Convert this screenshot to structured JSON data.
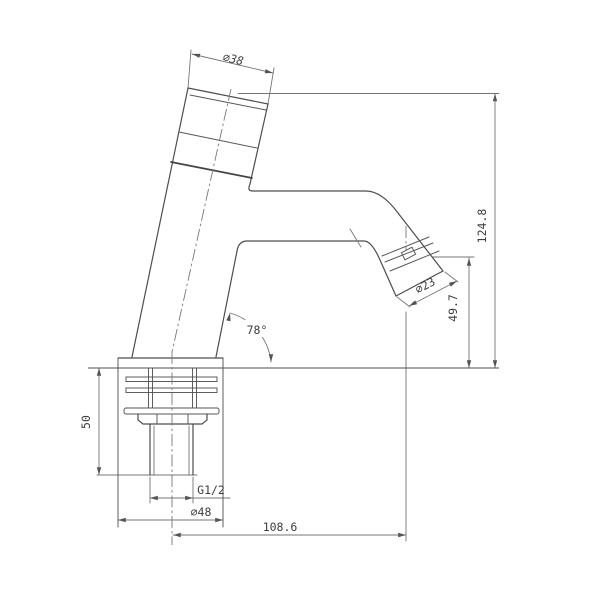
{
  "drawing": {
    "subject": "self-closing push-button basin tap, side elevation technical drawing",
    "background_color": "#ffffff",
    "outline_color": "#4d4d4d",
    "dimension_color": "#757575",
    "dimensions": {
      "cap_diameter": "⌀38",
      "total_height": "124.8",
      "outlet_diameter": "⌀23",
      "outlet_height": "49.7",
      "body_angle": "78°",
      "under_counter_height": "50",
      "inlet_thread": "G1/2",
      "base_diameter": "⌀48",
      "spout_reach": "108.6"
    }
  }
}
